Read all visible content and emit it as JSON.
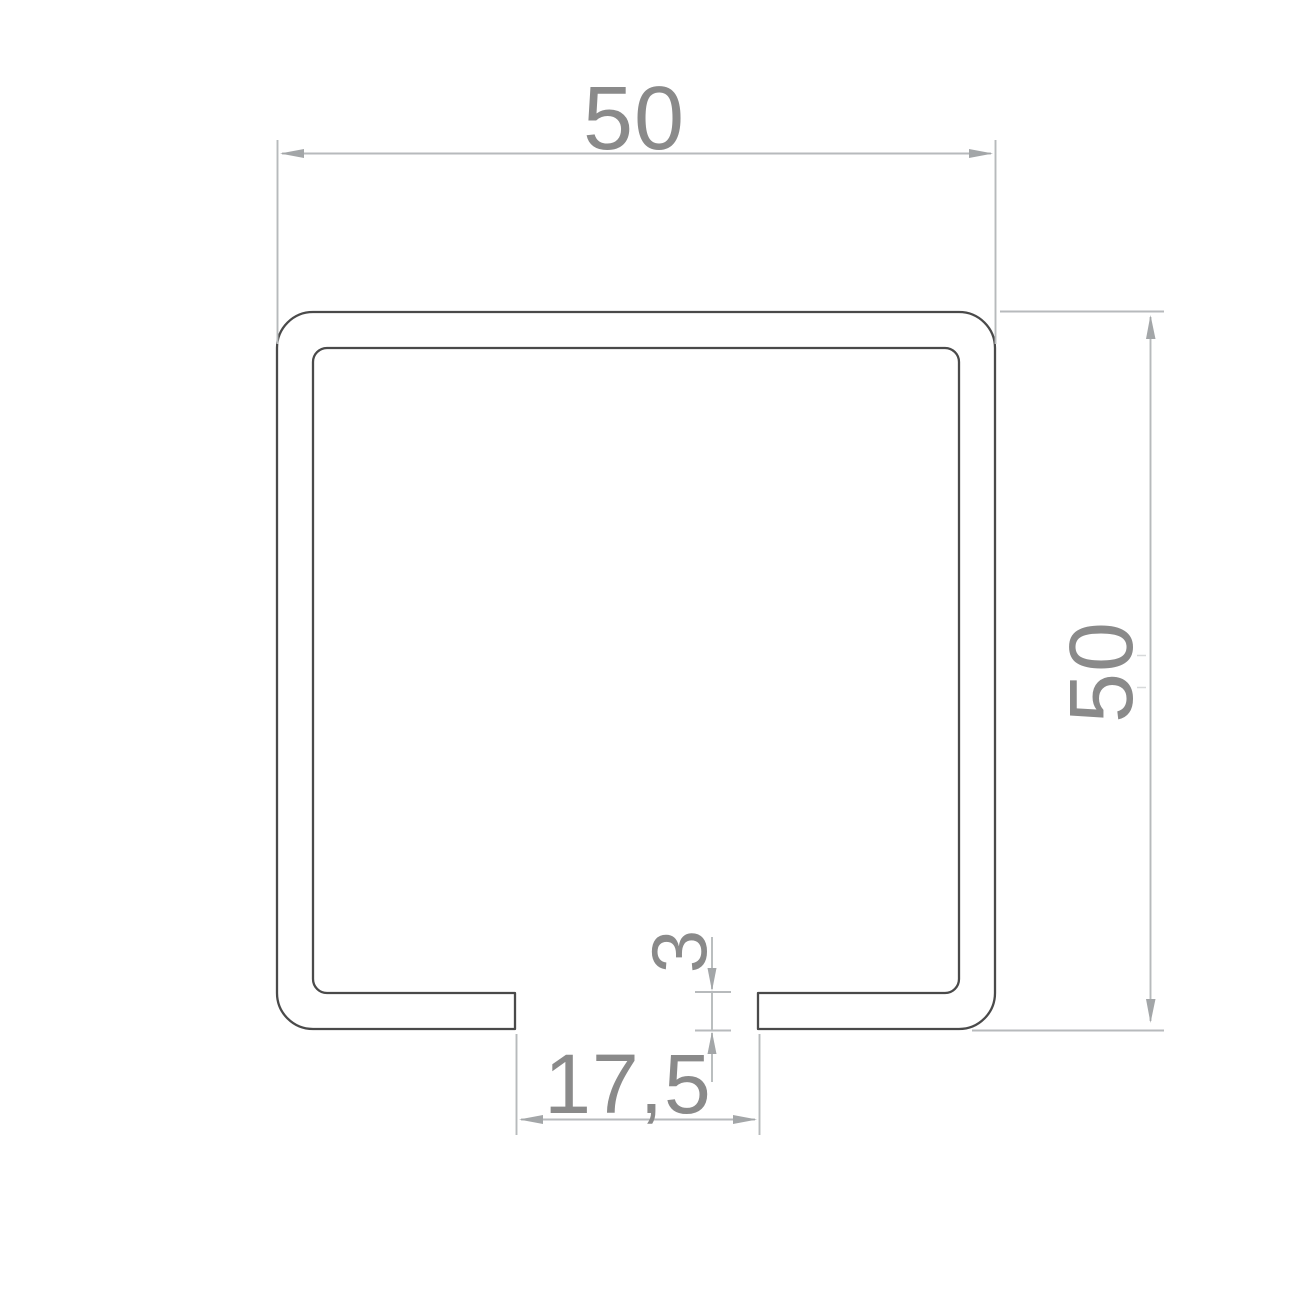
{
  "drawing": {
    "kind": "c-channel-profile-cross-section",
    "dimensions": {
      "outer_width_label": "50",
      "outer_height_label": "50",
      "lip_thickness_label": "3",
      "slot_width_label": "17,5"
    }
  },
  "colors": {
    "background": "#ffffff",
    "profile_outline": "#4a4a4a",
    "dimension_line": "#b7babc",
    "dimension_arrow": "#a3a6a8",
    "dimension_text": "#8a8a8a"
  }
}
